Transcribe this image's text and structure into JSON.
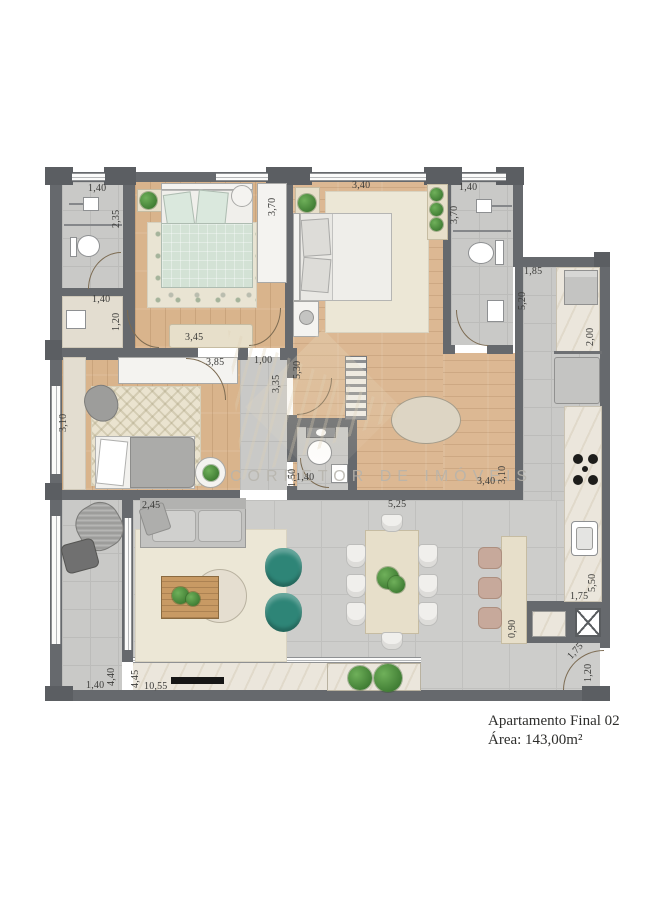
{
  "caption": {
    "line1": "Apartamento Final 02",
    "line2": "Área: 143,00m²"
  },
  "watermark": {
    "text": "CORRETOR DE IMÓVEIS"
  },
  "dimensions": [
    {
      "t": "1,40"
    },
    {
      "t": "2,35"
    },
    {
      "t": "1,40"
    },
    {
      "t": "1,20"
    },
    {
      "t": "3,70"
    },
    {
      "t": "3,45"
    },
    {
      "t": "3,85"
    },
    {
      "t": "1,00"
    },
    {
      "t": "3,35"
    },
    {
      "t": "5,30"
    },
    {
      "t": "3,40"
    },
    {
      "t": "3,40"
    },
    {
      "t": "3,10"
    },
    {
      "t": "1,40"
    },
    {
      "t": "3,70"
    },
    {
      "t": "1,85"
    },
    {
      "t": "5,20"
    },
    {
      "t": "2,00"
    },
    {
      "t": "5,50"
    },
    {
      "t": "1,75"
    },
    {
      "t": "0,90"
    },
    {
      "t": "1,75"
    },
    {
      "t": "1,20"
    },
    {
      "t": "3,10"
    },
    {
      "t": "1,50"
    },
    {
      "t": "1,40"
    },
    {
      "t": "2,45"
    },
    {
      "t": "5,25"
    },
    {
      "t": "4,40"
    },
    {
      "t": "1,40"
    },
    {
      "t": "4,45"
    },
    {
      "t": "10,55"
    }
  ],
  "colors": {
    "wall": "#66696d",
    "wood_floor": "#d9b48c",
    "tile_floor": "#c9c9c7",
    "marble": "#ebe6dc",
    "accent_teal": "#2e8577",
    "plant_green": "#4c9440",
    "mint_bed": "#d3e2d5",
    "label_text": "#3b3b39"
  }
}
